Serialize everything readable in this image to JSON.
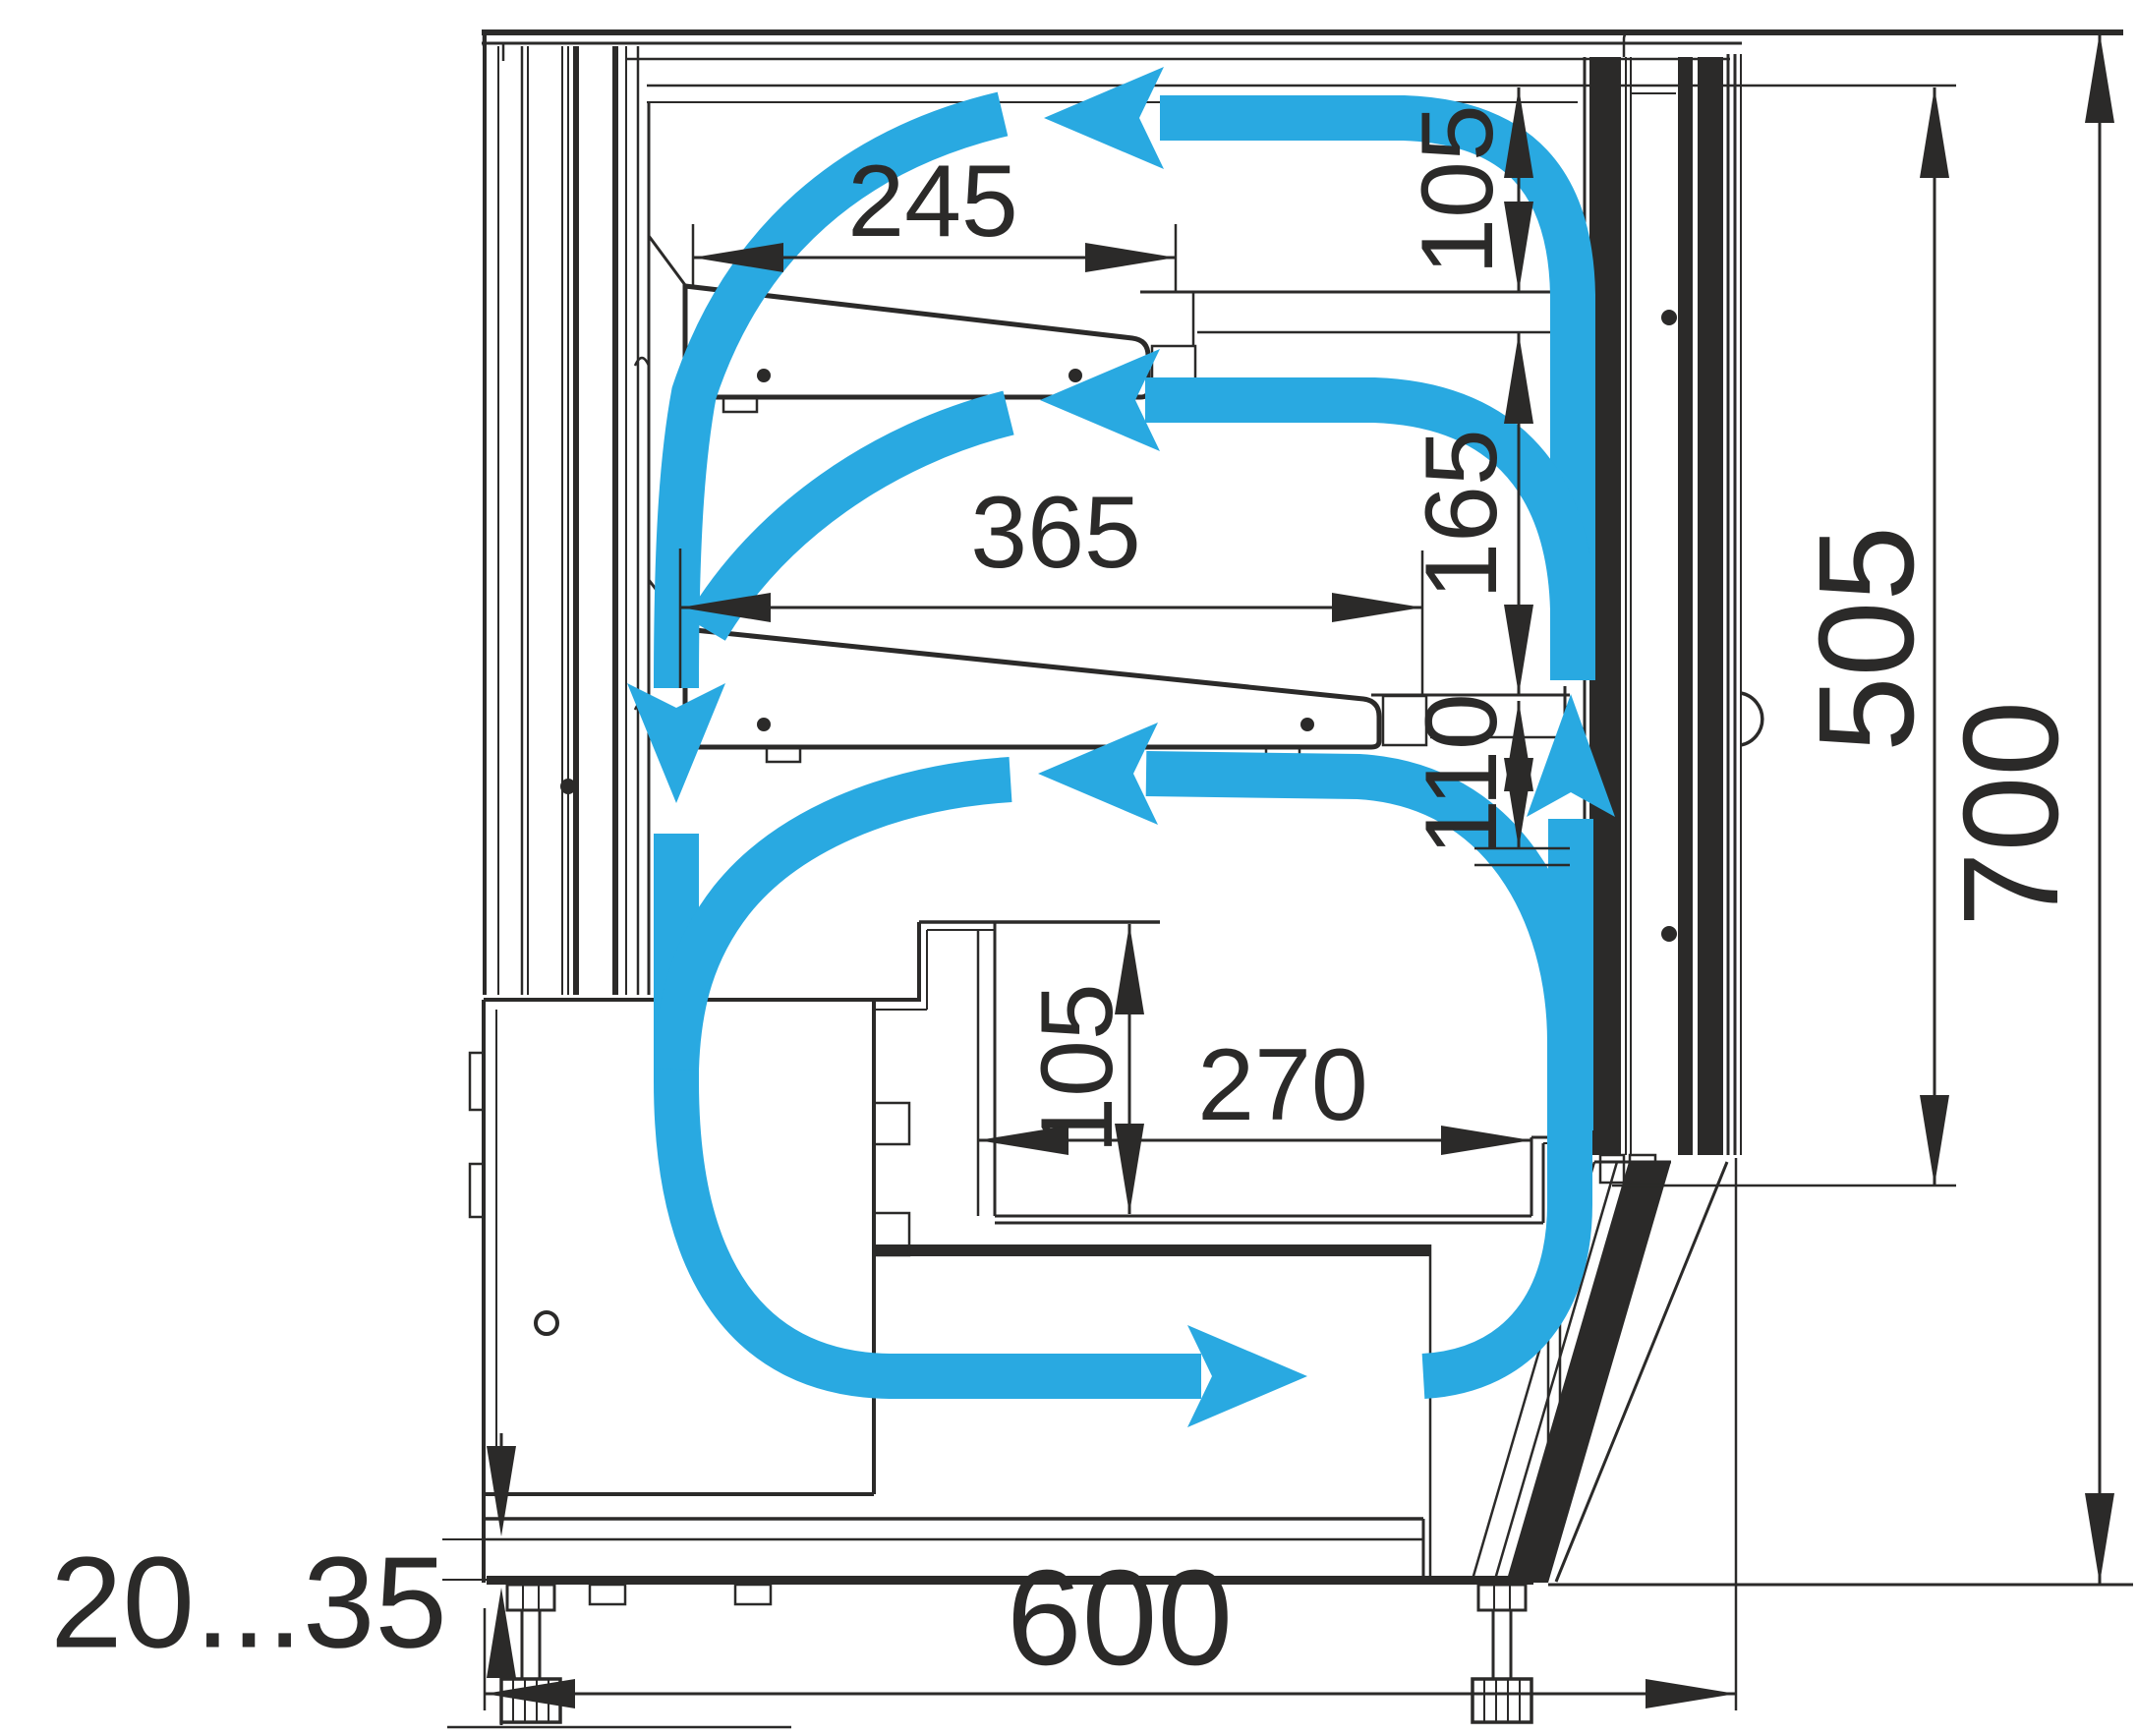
{
  "drawing": {
    "type": "technical-section-drawing",
    "subject": "refrigerated display case cross-section with air circulation",
    "colors": {
      "line": "#2b2a29",
      "airflow": "#29a9e1",
      "background": "#ffffff"
    },
    "labels": {
      "shelf1_width": "245",
      "top_clearance": "105",
      "shelf2_width": "365",
      "shelf_clearance": "165",
      "lower_clearance": "110",
      "well_depth": "105",
      "well_width": "270",
      "glass_height": "505",
      "overall_height": "700",
      "leg_adjust": "20...35",
      "overall_depth": "600"
    }
  }
}
